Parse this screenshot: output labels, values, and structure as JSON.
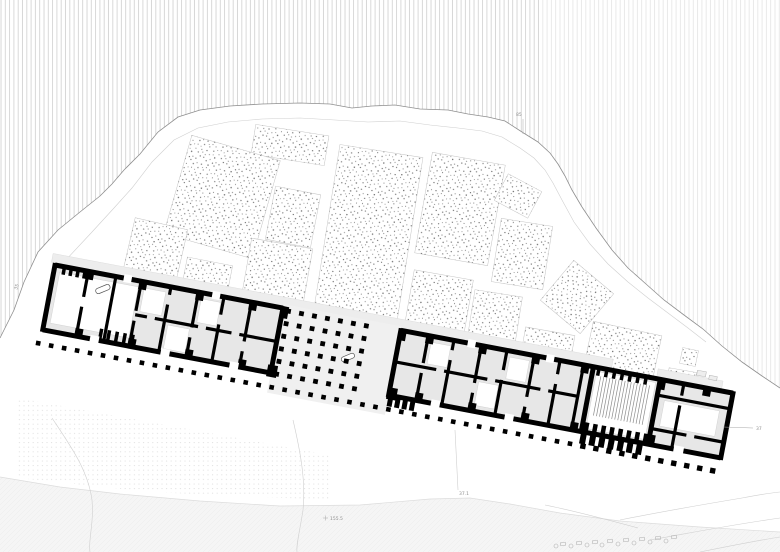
{
  "drawing": {
    "title": "archaeological-site-plan",
    "width": 780,
    "height": 552
  },
  "colors": {
    "background": "#ffffff",
    "hatch_line": "#c3c3c3",
    "contour_main": "#8f8f8f",
    "contour_light": "#cfcfcf",
    "block_border": "#c4c4c4",
    "stipple_dot": "#3c3c3c",
    "wall_black": "#000000",
    "room_gray": "#e7e7e7",
    "court_gray": "#f0f0f0",
    "terrace_gray": "#ededed",
    "stripe_gray": "#8c8c8c",
    "band_fill": "#f5f5f5",
    "band_edge": "#dcdcdc",
    "dotfield_dot": "#dedede",
    "rock_stroke": "#b5b5b5",
    "label_gray": "#8f8f8f"
  },
  "annotations": [
    {
      "text": "85",
      "x": 516,
      "y": 116,
      "rot": 0
    },
    {
      "text": "35",
      "x": 17,
      "y": 290,
      "rot": -72
    },
    {
      "text": "155.5",
      "x": 330,
      "y": 520,
      "rot": 0
    },
    {
      "text": "37.1",
      "x": 459,
      "y": 495,
      "rot": 0
    },
    {
      "text": "37",
      "x": 756,
      "y": 430,
      "rot": 0
    }
  ],
  "leaders": [
    [
      523,
      119,
      523,
      134
    ],
    [
      723,
      427,
      753,
      428
    ],
    [
      323,
      518,
      328,
      518
    ],
    [
      325.5,
      515.5,
      325.5,
      520.5
    ]
  ],
  "hill": {
    "outer": [
      [
        0,
        338
      ],
      [
        14,
        310
      ],
      [
        24,
        282
      ],
      [
        38,
        252
      ],
      [
        58,
        230
      ],
      [
        80,
        212
      ],
      [
        100,
        196
      ],
      [
        112,
        184
      ],
      [
        124,
        170
      ],
      [
        140,
        154
      ],
      [
        158,
        132
      ],
      [
        178,
        117
      ],
      [
        200,
        110
      ],
      [
        230,
        106
      ],
      [
        262,
        104
      ],
      [
        300,
        103
      ],
      [
        330,
        104
      ],
      [
        352,
        108
      ],
      [
        372,
        106
      ],
      [
        395,
        105
      ],
      [
        420,
        109
      ],
      [
        448,
        110
      ],
      [
        468,
        114
      ],
      [
        488,
        117
      ],
      [
        505,
        121
      ],
      [
        522,
        132
      ],
      [
        538,
        142
      ],
      [
        550,
        153
      ],
      [
        558,
        164
      ],
      [
        565,
        176
      ],
      [
        572,
        190
      ],
      [
        582,
        207
      ],
      [
        596,
        228
      ],
      [
        612,
        250
      ],
      [
        628,
        268
      ],
      [
        646,
        284
      ],
      [
        664,
        300
      ],
      [
        684,
        315
      ],
      [
        703,
        329
      ],
      [
        722,
        346
      ],
      [
        742,
        362
      ],
      [
        762,
        376
      ],
      [
        780,
        388
      ]
    ],
    "inner": [
      [
        64,
        262
      ],
      [
        92,
        232
      ],
      [
        114,
        208
      ],
      [
        132,
        188
      ],
      [
        152,
        162
      ],
      [
        174,
        140
      ],
      [
        198,
        128
      ],
      [
        228,
        122
      ],
      [
        262,
        119
      ],
      [
        300,
        118
      ],
      [
        335,
        120
      ],
      [
        368,
        122
      ],
      [
        400,
        121
      ],
      [
        430,
        125
      ],
      [
        458,
        128
      ],
      [
        482,
        131
      ],
      [
        502,
        137
      ],
      [
        520,
        148
      ],
      [
        534,
        158
      ],
      [
        545,
        170
      ],
      [
        553,
        183
      ],
      [
        562,
        200
      ],
      [
        574,
        222
      ],
      [
        590,
        244
      ],
      [
        608,
        264
      ],
      [
        628,
        282
      ],
      [
        648,
        298
      ],
      [
        668,
        313
      ],
      [
        688,
        328
      ],
      [
        706,
        342
      ]
    ]
  },
  "hatch": {
    "spacing": 4.3,
    "line_width": 0.65,
    "lighter_from_x": 540,
    "lighter_opacity": 0.45
  },
  "blocks": [
    [
      290,
      145,
      74,
      30,
      9
    ],
    [
      222,
      197,
      92,
      102,
      16
    ],
    [
      293,
      217,
      46,
      54,
      11
    ],
    [
      368,
      236,
      84,
      172,
      9
    ],
    [
      460,
      209,
      74,
      102,
      10
    ],
    [
      518,
      196,
      38,
      30,
      28
    ],
    [
      522,
      254,
      52,
      64,
      9
    ],
    [
      155,
      252,
      54,
      58,
      13
    ],
    [
      206,
      282,
      46,
      42,
      11
    ],
    [
      276,
      279,
      62,
      72,
      10
    ],
    [
      438,
      308,
      60,
      67,
      10
    ],
    [
      494,
      323,
      48,
      60,
      9
    ],
    [
      577,
      297,
      52,
      52,
      40
    ],
    [
      547,
      350,
      50,
      38,
      10
    ],
    [
      622,
      355,
      70,
      54,
      12
    ],
    [
      681,
      381,
      28,
      22,
      10
    ],
    [
      689,
      357,
      16,
      16,
      12
    ]
  ],
  "building": {
    "origin": [
      55,
      265
    ],
    "angle": 10.7,
    "length": 690,
    "height": 66,
    "terraces": [
      [
        -4,
        -11,
        570,
        9
      ],
      [
        612,
        -10,
        66,
        8
      ]
    ],
    "gray_fills": [
      [
        0,
        0,
        232,
        66
      ],
      [
        352,
        0,
        196,
        66
      ],
      [
        548,
        0,
        142,
        66
      ]
    ],
    "court_rect": [
      232,
      -4,
      120,
      90
    ],
    "white_rooms": [
      [
        6,
        6,
        80,
        52
      ],
      [
        92,
        6,
        22,
        24
      ],
      [
        122,
        38,
        22,
        24
      ],
      [
        150,
        6,
        20,
        24
      ],
      [
        384,
        6,
        20,
        22
      ],
      [
        438,
        36,
        20,
        24
      ],
      [
        464,
        6,
        20,
        22
      ],
      [
        552,
        4,
        60,
        58
      ],
      [
        624,
        20,
        56,
        26
      ]
    ],
    "stripes": {
      "x0": 557,
      "x1": 608,
      "step": 3.1,
      "y0": 8,
      "y1": 48
    },
    "combs": [
      [
        8,
        40,
        7,
        1,
        3.5,
        7
      ],
      [
        56,
        90,
        8,
        54,
        3.5,
        11
      ],
      [
        552,
        602,
        8,
        1,
        3.5,
        7
      ],
      [
        550,
        612,
        8.6,
        56,
        4.5,
        10
      ],
      [
        548,
        608,
        9.5,
        68,
        6,
        10
      ],
      [
        352,
        376,
        7.5,
        68,
        5,
        9
      ]
    ],
    "walls": {
      "outer_stroke": 5,
      "inner_stroke": 3.2,
      "top_segments": [
        [
          0,
          232
        ],
        [
          352,
          690
        ]
      ],
      "front_segments": [
        [
          0,
          232
        ],
        [
          352,
          690
        ]
      ],
      "end_walls": [
        0,
        232,
        352,
        548,
        616,
        690
      ],
      "vertical": [
        [
          34,
          [
            [
              26,
              36
            ]
          ]
        ],
        [
          62,
          []
        ],
        [
          88,
          [
            [
              30,
              40
            ]
          ]
        ],
        [
          118,
          [
            [
              8,
              18
            ]
          ]
        ],
        [
          146,
          [
            [
              36,
              46
            ]
          ]
        ],
        [
          172,
          [
            [
              18,
              28
            ]
          ]
        ],
        [
          200,
          [
            [
              40,
              50
            ]
          ]
        ],
        [
          380,
          [
            [
              28,
              38
            ]
          ]
        ],
        [
          406,
          [
            [
              10,
              20
            ]
          ]
        ],
        [
          434,
          [
            [
              38,
              48
            ]
          ]
        ],
        [
          460,
          [
            [
              20,
              30
            ]
          ]
        ],
        [
          488,
          [
            [
              42,
              52
            ]
          ]
        ],
        [
          514,
          [
            [
              14,
              24
            ]
          ]
        ],
        [
          538,
          []
        ],
        [
          640,
          [
            [
              12,
              22
            ]
          ]
        ]
      ],
      "horizontal": [
        [
          34,
          88,
          232,
          [
            [
              100,
              108
            ],
            [
              152,
              160
            ],
            [
              186,
              194
            ]
          ]
        ],
        [
          32,
          352,
          538,
          [
            [
              394,
              402
            ],
            [
              446,
              454
            ],
            [
              500,
              508
            ]
          ]
        ],
        [
          16,
          616,
          690,
          []
        ],
        [
          50,
          616,
          690,
          [
            [
              652,
              660
            ]
          ]
        ]
      ]
    },
    "piers": [
      [
        32,
        -2,
        8,
        10
      ],
      [
        86,
        -2,
        8,
        10
      ],
      [
        144,
        -2,
        8,
        10
      ],
      [
        198,
        -2,
        8,
        10
      ],
      [
        230,
        -2,
        8,
        12
      ],
      [
        350,
        -2,
        8,
        12
      ],
      [
        378,
        -2,
        8,
        10
      ],
      [
        432,
        -2,
        8,
        10
      ],
      [
        486,
        -2,
        8,
        10
      ],
      [
        536,
        -2,
        8,
        10
      ],
      [
        32,
        58,
        8,
        10
      ],
      [
        86,
        58,
        8,
        10
      ],
      [
        144,
        58,
        8,
        10
      ],
      [
        198,
        58,
        8,
        10
      ],
      [
        228,
        58,
        10,
        12
      ],
      [
        350,
        58,
        10,
        12
      ],
      [
        378,
        58,
        8,
        10
      ],
      [
        432,
        58,
        8,
        10
      ],
      [
        486,
        58,
        8,
        10
      ],
      [
        536,
        58,
        8,
        10
      ],
      [
        614,
        -2,
        8,
        12
      ],
      [
        614,
        56,
        8,
        12
      ],
      [
        660,
        -2,
        8,
        10
      ]
    ],
    "door_gaps": [
      [
        48,
        62,
        9,
        8
      ],
      [
        120,
        62,
        9,
        8
      ],
      [
        190,
        62,
        9,
        8
      ],
      [
        395,
        62,
        9,
        8
      ],
      [
        470,
        62,
        9,
        8
      ],
      [
        642,
        62,
        10,
        8
      ],
      [
        70,
        -4,
        8,
        8
      ],
      [
        160,
        -4,
        8,
        8
      ],
      [
        420,
        -4,
        8,
        8
      ],
      [
        500,
        -4,
        8,
        8
      ]
    ],
    "objects": [
      [
        44,
        12,
        15,
        5.5,
        -33
      ],
      [
        298,
        34,
        14,
        5,
        -33
      ]
    ]
  },
  "colonnade": {
    "y": 80,
    "x0": -2,
    "x1": 689,
    "step": 13.2,
    "size_small": 4.6,
    "size_large": 5.4,
    "large_from_x": 540
  },
  "court_grid": {
    "x0": 238,
    "cols": 7,
    "col_step": 13.2,
    "y0": 2,
    "rows": 6,
    "row_step": 12.8,
    "size": 4.8
  },
  "bottom_band": {
    "edge": [
      [
        0,
        477
      ],
      [
        60,
        487
      ],
      [
        120,
        494
      ],
      [
        200,
        501
      ],
      [
        280,
        506
      ],
      [
        360,
        505
      ],
      [
        430,
        499
      ],
      [
        470,
        498
      ],
      [
        510,
        504
      ],
      [
        560,
        513
      ],
      [
        620,
        521
      ],
      [
        700,
        527
      ],
      [
        780,
        532
      ]
    ]
  },
  "dot_field": {
    "polygon": [
      [
        18,
        398
      ],
      [
        330,
        455
      ],
      [
        330,
        500
      ],
      [
        150,
        492
      ],
      [
        18,
        478
      ]
    ]
  },
  "terrain_curves": [
    "M293,420 C300,450 306,480 303,510 C300,530 296,545 297,552",
    "M52,418 C70,445 88,470 92,500 C94,525 88,540 90,552",
    "M620,520 C660,512 700,505 742,498 C758,495 770,493 780,492",
    "M650,540 C690,533 730,525 780,518",
    "M700,552 C730,546 760,540 780,537",
    "M545,505 C575,511 605,519 638,528",
    "M455,430 C456,450 457,470 458,490"
  ],
  "rocks": [
    [
      556,
      546,
      0
    ],
    [
      563,
      544,
      1
    ],
    [
      571,
      546,
      0
    ],
    [
      579,
      543,
      1
    ],
    [
      587,
      545,
      0
    ],
    [
      595,
      542,
      1
    ],
    [
      602,
      545,
      0
    ],
    [
      610,
      541,
      1
    ],
    [
      618,
      544,
      0
    ],
    [
      626,
      540,
      1
    ],
    [
      634,
      543,
      0
    ],
    [
      642,
      539,
      1
    ],
    [
      650,
      542,
      0
    ],
    [
      658,
      538,
      1
    ],
    [
      666,
      541,
      0
    ],
    [
      674,
      537,
      1
    ]
  ],
  "fragments": [
    [
      697,
      371,
      9,
      5
    ],
    [
      709,
      376,
      8,
      4
    ]
  ]
}
